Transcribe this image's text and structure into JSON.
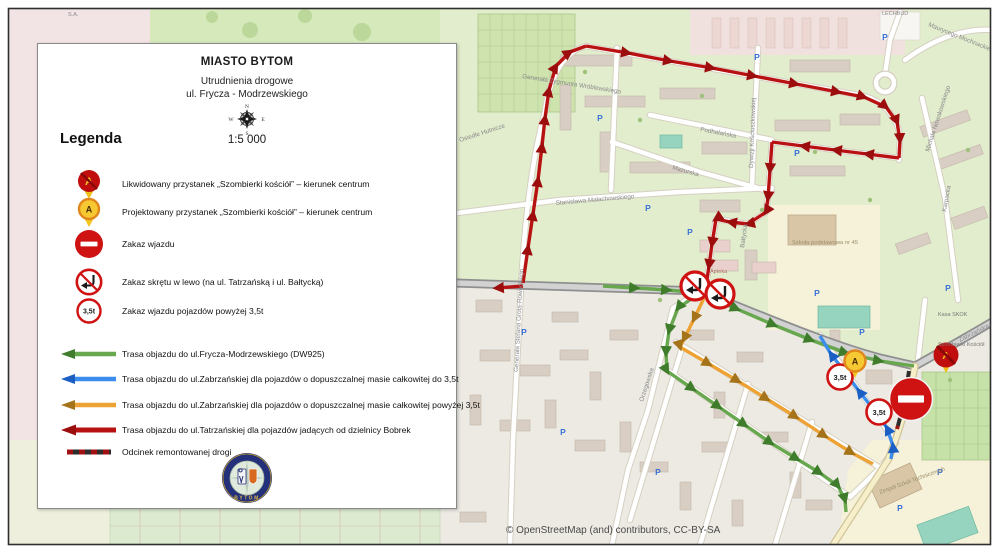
{
  "header": {
    "title": "MIASTO BYTOM",
    "subtitle_line1": "Utrudnienia drogowe",
    "subtitle_line2": "ul. Frycza - Modrzewskiego",
    "scale": "1:5 000",
    "compass": {
      "n": "N",
      "e": "E",
      "s": "S",
      "w": "W"
    }
  },
  "legend": {
    "heading": "Legenda",
    "items": [
      {
        "icon": "removed-stop-pin",
        "label": "Likwidowany przystanek „Szombierki kościół” – kierunek centrum"
      },
      {
        "icon": "planned-stop-pin",
        "label": "Projektowany przystanek „Szombierki kościół” – kierunek centrum"
      },
      {
        "icon": "no-entry-sign",
        "label": "Zakaz wjazdu"
      },
      {
        "icon": "no-left-turn-sign",
        "label": "Zakaz skrętu w lewo (na ul. Tatrzańską i ul. Bałtycką)"
      },
      {
        "icon": "weight-limit-sign",
        "label": "Zakaz wjazdu pojazdów powyżej 3,5t"
      }
    ],
    "routes": [
      {
        "color": "#67a74e",
        "label": "Trasa objazdu do ul.Frycza-Modrzewskiego (DW925)"
      },
      {
        "color": "#3c8ced",
        "label": "Trasa objazdu do ul.Zabrzańskiej dla pojazdów o dopuszczalnej masie całkowitej do 3,5t"
      },
      {
        "color": "#eda233",
        "label": "Trasa objazdu do ul.Zabrzańskiej dla pojazdów o dopuszczalnej masie całkowitej powyżej 3,5t"
      },
      {
        "color": "#b81111",
        "label": "Trasa objazdu do ul.Tatrzańskiej dla pojazdów jadących od dzielnicy Bobrek"
      },
      {
        "color": "#8b1313",
        "label": "Odcinek remontowanej drogi"
      }
    ],
    "logo_text": "BYTOM"
  },
  "signs": {
    "weight_limit": "3,5t",
    "stop_letter": "A"
  },
  "map": {
    "attribution": "© OpenStreetMap (and) contributors, CC-BY-SA",
    "parking_glyph": "P",
    "streets": [
      "Generała Zygmunta Wróblewskiego",
      "Dywizji Kościuszkowskiej",
      "Podhalańska",
      "Mazurska",
      "Stanisława Małachowskiego",
      "Bałtycka",
      "Orzegowska",
      "Osiedle Hutnicze",
      "Maurycego Mochnackiego",
      "Michała Nowakowskiego",
      "Karpacka",
      "Zabrzańska",
      "Szombierki Kościół",
      "Zespół Szkół Technicznych",
      "Szkoła podstawowa nr 45",
      "Kasa SKOK",
      "Apteka",
      "LECHBUD",
      "Generała Stefana Grota-Roweckiego",
      "S.A."
    ]
  }
}
